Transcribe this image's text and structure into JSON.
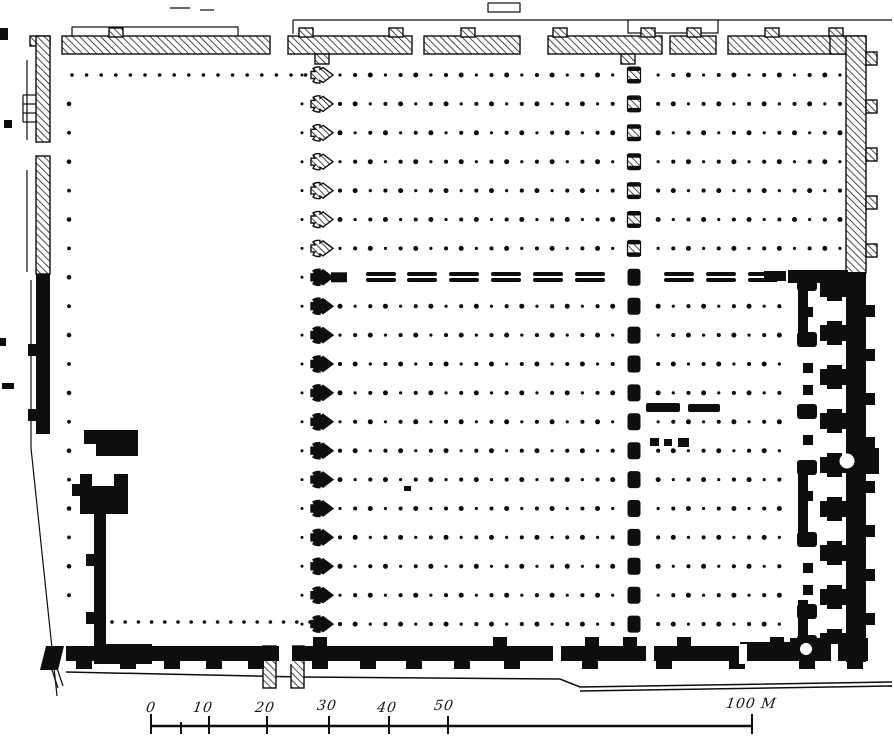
{
  "canvas": {
    "width": 894,
    "height": 753,
    "ink": "#0e0e0e",
    "paper": "#ffffff"
  },
  "plan": {
    "rows": {
      "y0": 75,
      "dy": 28.9,
      "count": 20,
      "dash_row": 7
    },
    "hall_dots": {
      "x0": 340,
      "dx": 15.15,
      "count": 34,
      "skip_j": [
        19,
        20
      ],
      "max_x_below_dash": 786
    },
    "courtyard_dots": {
      "top": {
        "y": 75,
        "x0": 72,
        "step": 14.6,
        "count": 17
      },
      "left_col": {
        "x": 69,
        "from": 1,
        "to": 18
      },
      "right_col": {
        "x": 302,
        "from": 0,
        "to": 19
      },
      "bottom": {
        "y": 622,
        "x0": 112,
        "step": 13.2,
        "count": 16
      }
    },
    "pier_col_arrow": {
      "cx": 322,
      "hatched_until": 7
    },
    "pier_col_capsule": {
      "cx": 634,
      "hatched_until": 7
    },
    "dash_row": {
      "y": 272,
      "w": 30,
      "h": 10,
      "xs": [
        366,
        407,
        449,
        491,
        533,
        575,
        664,
        706,
        748
      ]
    },
    "fragments": {
      "dashes": [
        [
          646,
          403,
          34,
          9
        ],
        [
          688,
          404,
          32,
          8
        ]
      ],
      "squares": [
        [
          650,
          438,
          9,
          8
        ],
        [
          664,
          439,
          8,
          7
        ],
        [
          678,
          438,
          11,
          9
        ],
        [
          404,
          486,
          7,
          5
        ]
      ]
    },
    "hatch_rects": [
      [
        62,
        36,
        208,
        18,
        "top-wall-segment"
      ],
      [
        288,
        36,
        124,
        18,
        "top-wall-segment"
      ],
      [
        424,
        36,
        96,
        18,
        "top-wall-segment"
      ],
      [
        548,
        36,
        114,
        18,
        "top-wall-segment"
      ],
      [
        670,
        36,
        46,
        18,
        "top-wall-segment"
      ],
      [
        728,
        36,
        116,
        18,
        "top-wall-segment"
      ],
      [
        109,
        28,
        14,
        9,
        "buttress-tab"
      ],
      [
        299,
        28,
        14,
        9,
        "buttress-tab"
      ],
      [
        389,
        28,
        14,
        9,
        "buttress-tab"
      ],
      [
        461,
        28,
        14,
        9,
        "buttress-tab"
      ],
      [
        553,
        28,
        14,
        9,
        "buttress-tab"
      ],
      [
        641,
        28,
        14,
        9,
        "buttress-tab"
      ],
      [
        687,
        28,
        14,
        9,
        "buttress-tab"
      ],
      [
        765,
        28,
        14,
        9,
        "buttress-tab"
      ],
      [
        829,
        28,
        14,
        9,
        "buttress-tab"
      ],
      [
        315,
        54,
        14,
        10,
        "buttress-tab"
      ],
      [
        621,
        54,
        14,
        10,
        "buttress-tab"
      ],
      [
        830,
        36,
        36,
        18,
        "top-right-corner"
      ],
      [
        846,
        36,
        20,
        237,
        "right-wall-hatched"
      ],
      [
        866,
        52,
        11,
        13,
        "buttress-tab"
      ],
      [
        866,
        100,
        11,
        13,
        "buttress-tab"
      ],
      [
        866,
        148,
        11,
        13,
        "buttress-tab"
      ],
      [
        866,
        196,
        11,
        13,
        "buttress-tab"
      ],
      [
        866,
        244,
        11,
        13,
        "buttress-tab"
      ],
      [
        30,
        36,
        20,
        10,
        "left-wall-corner"
      ],
      [
        36,
        36,
        14,
        106,
        "left-wall-segment"
      ],
      [
        36,
        156,
        14,
        118,
        "left-wall-segment"
      ],
      [
        263,
        646,
        13,
        42,
        "door-jamb"
      ],
      [
        291,
        646,
        13,
        42,
        "door-jamb"
      ]
    ],
    "black_rects": [
      [
        36,
        274,
        14,
        160,
        "left-wall-black"
      ],
      [
        28,
        344,
        8,
        12,
        "buttress-tab"
      ],
      [
        28,
        409,
        8,
        12,
        "buttress-tab"
      ],
      [
        84,
        430,
        54,
        26,
        "left-gate-block"
      ],
      [
        80,
        474,
        48,
        40,
        "left-gate-block"
      ],
      [
        72,
        484,
        8,
        12,
        "buttress-tab"
      ],
      [
        94,
        514,
        12,
        134,
        "left-wall-lower"
      ],
      [
        86,
        554,
        8,
        12,
        "buttress-tab"
      ],
      [
        86,
        612,
        8,
        12,
        "buttress-tab"
      ],
      [
        94,
        644,
        58,
        20,
        "bottom-left-corner"
      ],
      [
        66,
        646,
        802,
        15,
        "bottom-wall"
      ],
      [
        76,
        660,
        16,
        9,
        "buttress-tab"
      ],
      [
        120,
        660,
        16,
        9,
        "buttress-tab"
      ],
      [
        164,
        660,
        16,
        9,
        "buttress-tab"
      ],
      [
        206,
        660,
        16,
        9,
        "buttress-tab"
      ],
      [
        248,
        660,
        16,
        9,
        "buttress-tab"
      ],
      [
        312,
        660,
        16,
        9,
        "buttress-tab"
      ],
      [
        360,
        660,
        16,
        9,
        "buttress-tab"
      ],
      [
        406,
        660,
        16,
        9,
        "buttress-tab"
      ],
      [
        454,
        660,
        16,
        9,
        "buttress-tab"
      ],
      [
        504,
        660,
        16,
        9,
        "buttress-tab"
      ],
      [
        582,
        660,
        16,
        9,
        "buttress-tab"
      ],
      [
        656,
        660,
        16,
        9,
        "buttress-tab"
      ],
      [
        729,
        660,
        16,
        9,
        "buttress-tab"
      ],
      [
        799,
        660,
        16,
        9,
        "buttress-tab"
      ],
      [
        847,
        660,
        16,
        9,
        "buttress-tab"
      ],
      [
        313,
        637,
        14,
        9,
        "wall-bump"
      ],
      [
        493,
        637,
        14,
        9,
        "wall-bump"
      ],
      [
        585,
        637,
        14,
        9,
        "wall-bump"
      ],
      [
        623,
        637,
        14,
        9,
        "wall-bump"
      ],
      [
        677,
        637,
        14,
        9,
        "wall-bump"
      ],
      [
        770,
        637,
        14,
        9,
        "wall-bump"
      ],
      [
        848,
        637,
        14,
        9,
        "wall-bump"
      ],
      [
        846,
        272,
        20,
        390,
        "right-wall-black"
      ],
      [
        866,
        305,
        9,
        12,
        "wall-bump"
      ],
      [
        866,
        349,
        9,
        12,
        "wall-bump"
      ],
      [
        866,
        393,
        9,
        12,
        "wall-bump"
      ],
      [
        866,
        437,
        9,
        12,
        "wall-bump"
      ],
      [
        866,
        481,
        9,
        12,
        "wall-bump"
      ],
      [
        866,
        525,
        9,
        12,
        "wall-bump"
      ],
      [
        866,
        569,
        9,
        12,
        "wall-bump"
      ],
      [
        866,
        613,
        9,
        12,
        "wall-bump"
      ],
      [
        866,
        448,
        13,
        26,
        "mihrab-bump"
      ],
      [
        788,
        270,
        60,
        13,
        "sanctuary-connector"
      ],
      [
        764,
        271,
        22,
        10,
        "sanctuary-dash"
      ],
      [
        790,
        638,
        78,
        23,
        "sanctuary-connector"
      ],
      [
        740,
        642,
        52,
        12,
        "sanctuary-arm"
      ],
      [
        798,
        284,
        10,
        58,
        "sanctuary-partition"
      ],
      [
        798,
        468,
        10,
        73,
        "sanctuary-partition"
      ],
      [
        798,
        600,
        10,
        44,
        "sanctuary-partition"
      ]
    ],
    "cross_pier_cys": [
      289,
      333,
      377,
      421,
      465,
      509,
      553,
      597,
      641
    ],
    "inner_pier_cys": [
      284,
      340,
      412,
      468,
      540,
      612,
      643
    ],
    "inner_square_cys": [
      312,
      368,
      390,
      440,
      496,
      568,
      590
    ],
    "white_notches": [
      [
        84,
        444,
        12,
        12
      ],
      [
        92,
        474,
        22,
        12
      ],
      [
        279,
        644,
        13,
        20
      ],
      [
        553,
        644,
        8,
        20
      ],
      [
        646,
        644,
        8,
        20
      ],
      [
        739,
        644,
        8,
        20
      ],
      [
        831,
        644,
        7,
        20
      ]
    ],
    "white_circles": [
      [
        847,
        461,
        7.5
      ],
      [
        806,
        649,
        6
      ]
    ],
    "flare_poly": [
      [
        46,
        646
      ],
      [
        64,
        646
      ],
      [
        58,
        670
      ],
      [
        40,
        670
      ]
    ],
    "outline_lines": [
      [
        293,
        20,
        892,
        20
      ],
      [
        293,
        20,
        293,
        34
      ],
      [
        170,
        8,
        190,
        8
      ],
      [
        200,
        10,
        214,
        10
      ],
      [
        23,
        95,
        39,
        95
      ],
      [
        23,
        104,
        39,
        104
      ],
      [
        23,
        113,
        39,
        113
      ],
      [
        23,
        122,
        39,
        122
      ],
      [
        23,
        95,
        23,
        122
      ],
      [
        27,
        60,
        27,
        140
      ],
      [
        27,
        170,
        27,
        272
      ],
      [
        31,
        280,
        31,
        448
      ],
      [
        31,
        448,
        57,
        696
      ],
      [
        50,
        664,
        58,
        688
      ],
      [
        55,
        662,
        63,
        686
      ]
    ],
    "outline_rects": [
      [
        628,
        20,
        90,
        13
      ],
      [
        488,
        3,
        32,
        9
      ],
      [
        72,
        27,
        166,
        10
      ]
    ],
    "ground_polylines": [
      [
        [
          66,
          672
        ],
        [
          300,
          677
        ],
        [
          560,
          679
        ],
        [
          580,
          687
        ],
        [
          892,
          682
        ]
      ],
      [
        [
          580,
          691
        ],
        [
          892,
          686
        ]
      ]
    ],
    "edge_marks": [
      [
        0,
        28,
        8,
        12
      ],
      [
        4,
        120,
        8,
        8
      ],
      [
        0,
        338,
        6,
        8
      ],
      [
        2,
        383,
        12,
        6
      ]
    ]
  },
  "scale_bar": {
    "unit": "M",
    "line": [
      151,
      726,
      752,
      726
    ],
    "ticks": [
      {
        "x": 151,
        "h": 18
      },
      {
        "x": 181,
        "h": 10
      },
      {
        "x": 209,
        "h": 16
      },
      {
        "x": 267,
        "h": 16
      },
      {
        "x": 329,
        "h": 16
      },
      {
        "x": 389,
        "h": 16
      },
      {
        "x": 448,
        "h": 16
      },
      {
        "x": 752,
        "h": 18
      }
    ],
    "labels": [
      {
        "text": "0",
        "x": 146,
        "y": 700
      },
      {
        "text": "10",
        "x": 193,
        "y": 700
      },
      {
        "text": "20",
        "x": 255,
        "y": 700
      },
      {
        "text": "30",
        "x": 317,
        "y": 698
      },
      {
        "text": "40",
        "x": 377,
        "y": 700
      },
      {
        "text": "50",
        "x": 434,
        "y": 698
      },
      {
        "text": "100 M",
        "x": 726,
        "y": 696
      }
    ]
  }
}
